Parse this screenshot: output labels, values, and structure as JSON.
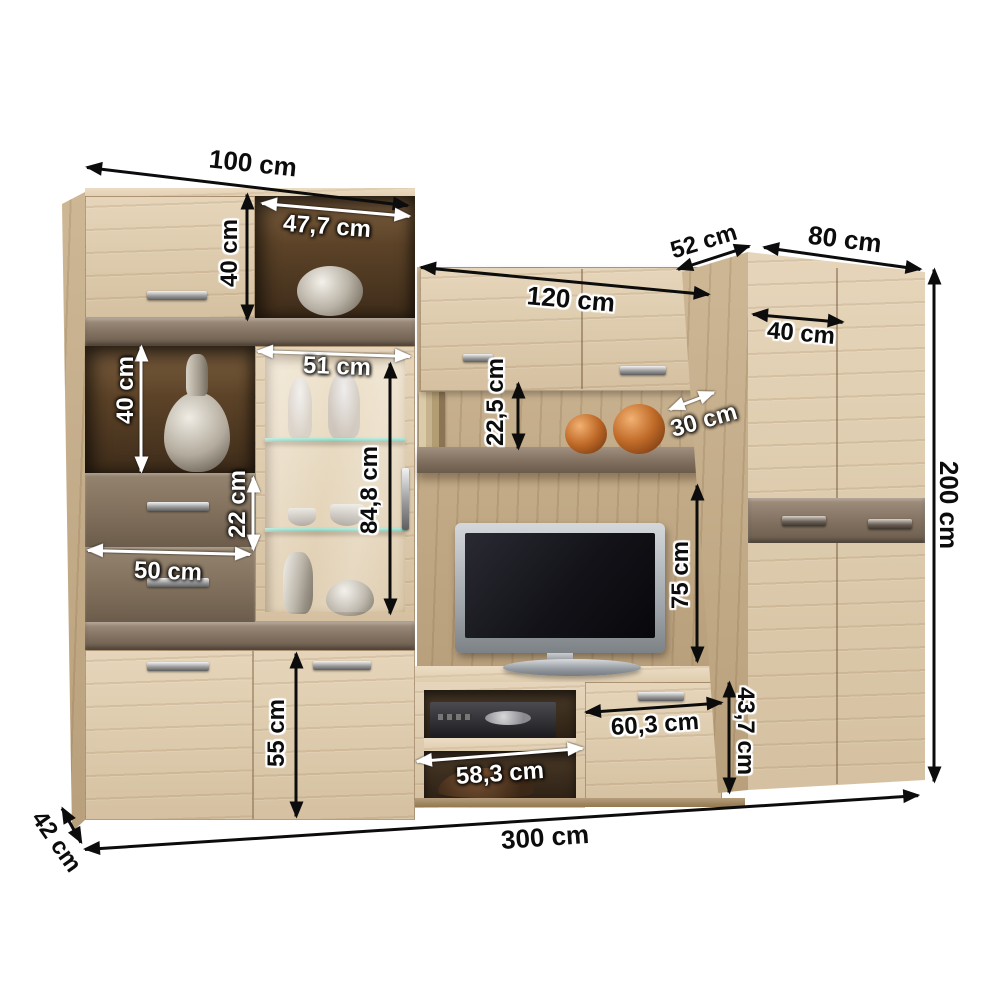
{
  "colors": {
    "background": "#ffffff",
    "wood_light": "#ddcaae",
    "wood_medium": "#c3ac8a",
    "accent_taupe": "#81705f",
    "interior_dark": "#4a3723",
    "arrow_black": "#0c0c0c",
    "arrow_white": "#ffffff",
    "glass_shelf_green": "#8fd7c2",
    "copper": "#b5672f",
    "tv_screen": "#141419"
  },
  "dimensions": {
    "left_unit_width": "100 cm",
    "left_top_niche_width": "47,7 cm",
    "left_top_cabinet_height": "40 cm",
    "left_mid_niche_height": "40 cm",
    "glass_door_width": "51 cm",
    "drawer_height": "22 cm",
    "drawer_width": "50 cm",
    "glass_section_height": "84,8 cm",
    "bottom_door_height": "55 cm",
    "left_unit_depth": "42 cm",
    "total_width": "300 cm",
    "wall_cabinet_width": "120 cm",
    "right_unit_depth": "52 cm",
    "right_unit_width": "80 cm",
    "right_door_width": "40 cm",
    "total_height": "200 cm",
    "shelf_clearance_height": "22,5 cm",
    "shelf_depth": "30 cm",
    "tv_niche_height": "75 cm",
    "bench_door_width": "60,3 cm",
    "bench_height": "43,7 cm",
    "bench_niche_width": "58,3 cm"
  }
}
